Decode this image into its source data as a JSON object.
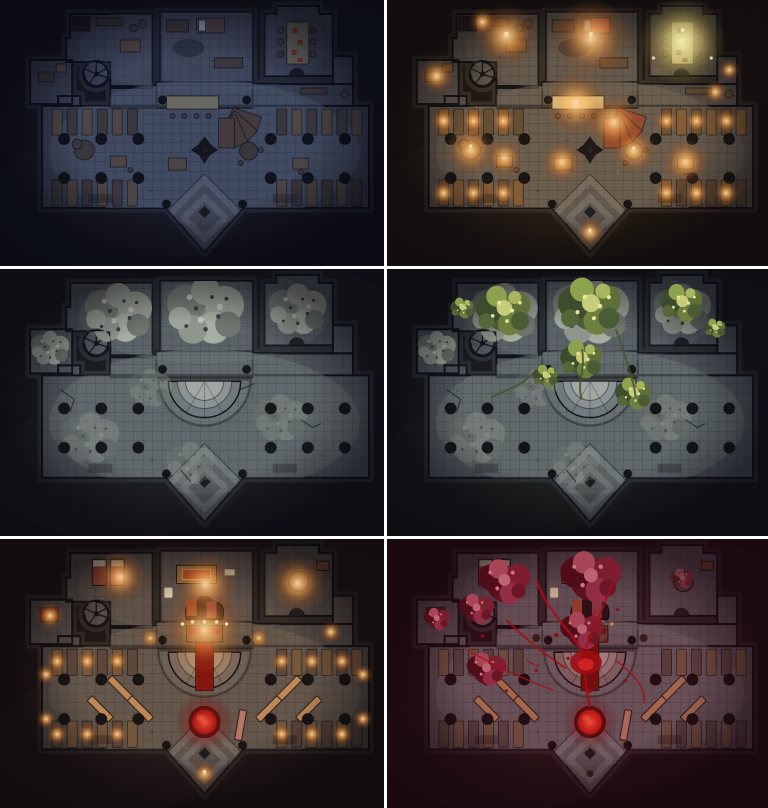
{
  "page": {
    "kind": "battle-map variant sheet",
    "gutter_color": "#ffffff",
    "grid": {
      "columns": 2,
      "rows": 3
    }
  },
  "panels": [
    {
      "id": "tavern-dark",
      "label": "unlit tavern",
      "base": "tavern",
      "overlays": [],
      "vars": {
        "bg": "#141419",
        "floor": "#434a5c",
        "floor2": "#5c6780",
        "wall": "#262b36",
        "wood": "#60524a",
        "wood2": "#868070",
        "woodDark": "#45403e",
        "woodR": "#52443e",
        "bed": "#5f4a52",
        "tint": "rgba(22,30,58,0.26)"
      }
    },
    {
      "id": "tavern-lit",
      "label": "lit tavern",
      "base": "tavern",
      "overlays": [
        "tavern-lights"
      ],
      "vars": {
        "bg": "#17130f",
        "floor": "#56504a",
        "floor2": "#6e6355",
        "wall": "#2e2a24",
        "wood": "#7d5a36",
        "wood2": "#ddd29a",
        "woodDark": "#5e4a34",
        "woodR": "#8a4632",
        "bed": "#b85a4a",
        "tint": "rgba(255,150,60,0.05)"
      }
    },
    {
      "id": "ruins",
      "label": "abandoned ruins",
      "base": "ruin",
      "overlays": [],
      "vars": {
        "bg": "#151518",
        "floor": "#4e545b",
        "floor2": "#6e7578",
        "wall": "#282c31",
        "dais1": "#6f777a",
        "dais2": "#8b9294",
        "dais3": "#a2a8a4",
        "tint": "rgba(150,170,170,0.05)"
      }
    },
    {
      "id": "ruins-overgrown",
      "label": "overgrown ruins",
      "base": "ruin",
      "overlays": [
        "foliage"
      ],
      "vars": {
        "bg": "#151518",
        "floor": "#4e545b",
        "floor2": "#6e7578",
        "wall": "#282c31",
        "dais1": "#6f777a",
        "dais2": "#8b9294",
        "dais3": "#a2a8a4",
        "tint": "rgba(150,180,150,0.04)"
      }
    },
    {
      "id": "temple-lit",
      "label": "ritual temple lit",
      "base": "temple",
      "overlays": [
        "temple-lights"
      ],
      "vars": {
        "bg": "#171114",
        "floor": "#4f4a45",
        "floor2": "#6c6154",
        "wall": "#2a2522",
        "wood": "#6e563c",
        "wood2": "#8a7a60",
        "woodDark": "#55443a",
        "woodR": "#7a4632",
        "dais1": "#75685c",
        "dais2": "#93836f",
        "dais3": "#ab9a82",
        "carpet": "#7e120d",
        "orb": "#8d130d",
        "bench": "#b98a5c",
        "tint": "rgba(255,120,50,0.05)"
      }
    },
    {
      "id": "temple-blood",
      "label": "blood-soaked temple",
      "base": "temple",
      "overlays": [
        "blood"
      ],
      "vars": {
        "bg": "#161013",
        "floor": "#56535a",
        "floor2": "#6e6a70",
        "wall": "#2a2328",
        "wood": "#6a5644",
        "wood2": "#8a7a68",
        "woodDark": "#504440",
        "woodR": "#6e4236",
        "dais1": "#7d6a6a",
        "dais2": "#968080",
        "dais3": "#ab9494",
        "carpet": "#6e100e",
        "orb": "#c01b12",
        "bench": "#a8795a",
        "tint": "rgba(140,20,30,0.10)"
      }
    }
  ],
  "palette": {
    "glow_warm": "#ffa94e",
    "glow_yellow": "#e8d77c",
    "glow_red": "#c01818",
    "foliage_bright": "#cfd080",
    "blood": "#a61016",
    "stone_dark": "#0b0d12"
  }
}
